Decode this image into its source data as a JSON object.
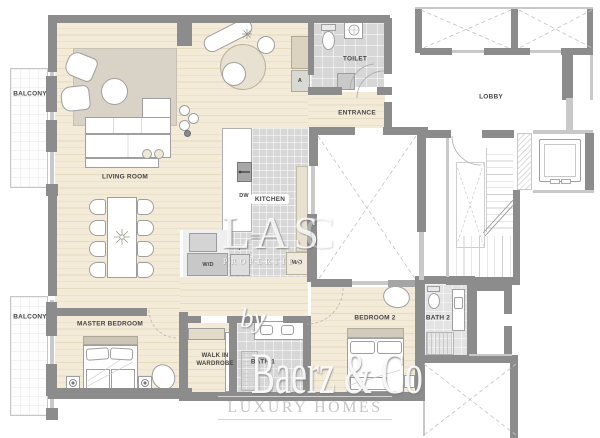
{
  "plan": {
    "type": "apartment-floor-plan",
    "rooms": {
      "balcony_top": "BALCONY",
      "balcony_bottom": "BALCONY",
      "living_room": "LIVING ROOM",
      "kitchen": "KITCHEN",
      "entrance": "ENTRANCE",
      "toilet": "TOILET",
      "lobby": "LOBBY",
      "master_bedroom": "MASTER BEDROOM",
      "walk_in_line1": "WALK IN",
      "walk_in_line2": "WARDROBE",
      "bath_1": "BATH 1",
      "bedroom_2": "BEDROOM 2",
      "bath_2": "BATH 2"
    },
    "appliances": {
      "dishwasher": "DW",
      "fridge": "f",
      "washer_dryer": "W/D",
      "micro_oven": "M/O",
      "cabinet": "A"
    },
    "watermarks": {
      "center_name": "LAS",
      "center_name_faint": "C",
      "center_sub": "PROPERTIES",
      "brand_by": "by",
      "brand_name": "Baerz & Co",
      "brand_tagline": "LUXURY HOMES"
    },
    "colors": {
      "wall": "#8c8c8c",
      "wall_light": "#c9c9c9",
      "wood": "#f3ead8",
      "wood_line": "#e6dabf",
      "tile": "#d7d7d7",
      "rug": "#d9d3c7",
      "beige": "#e9e1cf",
      "label": "#454545"
    }
  }
}
